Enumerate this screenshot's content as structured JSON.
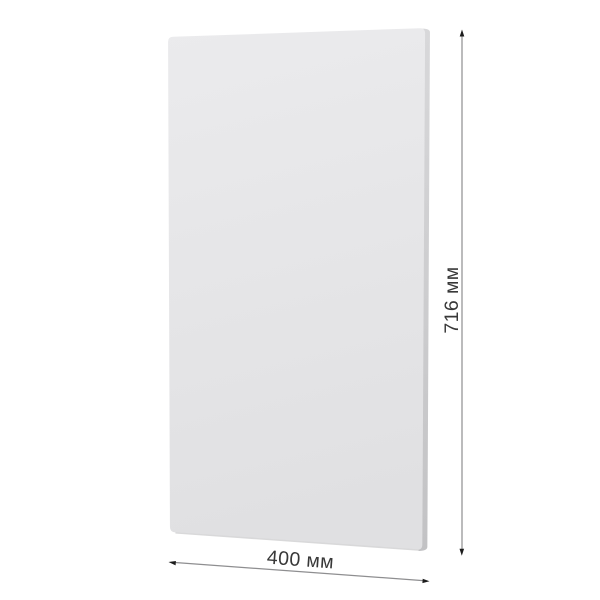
{
  "diagram": {
    "kind": "product-dimension-drawing",
    "object": "flat rectangular furniture panel (facade), slight perspective view",
    "labels": {
      "width": "400 мм",
      "height": "716 мм"
    },
    "values": {
      "width_mm": 400,
      "height_mm": 716,
      "unit": "мм"
    },
    "colors": {
      "background": "#ffffff",
      "panel_face_top": "#ebebed",
      "panel_face_bottom": "#e0e0e2",
      "panel_edge_top": "#d8d8da",
      "panel_edge_bottom": "#c2c2c4",
      "panel_bottom_shade": "#d2d2d4",
      "dim_line": "#8e8e90",
      "arrowhead": "#1c1c1c",
      "text": "#383838"
    }
  }
}
